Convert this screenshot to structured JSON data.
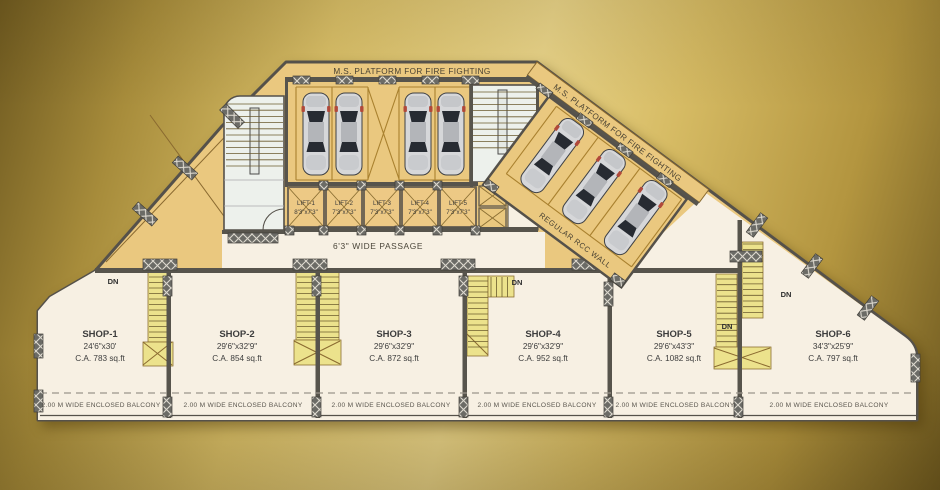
{
  "colors": {
    "gold-dark": "#6f5a20",
    "gold-mid": "#d9bf68",
    "gold-bright": "#e9d489",
    "plan-tan": "#eac87f",
    "plan-cream": "#f7f0e3",
    "stair-yellow": "#ece28c",
    "stair-floor": "#edf1ec",
    "wall-gray": "#57544c"
  },
  "plan": {
    "fire_platform_top": "M.S. PLATFORM FOR FIRE FIGHTING",
    "fire_platform_angled": "M.S. PLATFORM FOR FIRE FIGHTING",
    "rcc_wall": "REGULAR RCC WALL",
    "passage": "6'3\" WIDE PASSAGE",
    "down_label": "DN",
    "balcony": "2.00 M WIDE ENCLOSED BALCONY",
    "lifts": [
      {
        "name": "LIFT-1",
        "size": "8'3\"x7'3\""
      },
      {
        "name": "LIFT-2",
        "size": "7'3\"x7'3\""
      },
      {
        "name": "LIFT-3",
        "size": "7'3\"x7'3\""
      },
      {
        "name": "LIFT-4",
        "size": "7'3\"x7'3\""
      },
      {
        "name": "LIFT-5",
        "size": "7'3\"x7'3\""
      }
    ],
    "shops": [
      {
        "name": "SHOP-1",
        "size": "24'6\"x30'",
        "area": "C.A. 783 sq.ft"
      },
      {
        "name": "SHOP-2",
        "size": "29'6\"x32'9\"",
        "area": "C.A. 854 sq.ft"
      },
      {
        "name": "SHOP-3",
        "size": "29'6\"x32'9\"",
        "area": "C.A. 872 sq.ft"
      },
      {
        "name": "SHOP-4",
        "size": "29'6\"x32'9\"",
        "area": "C.A. 952 sq.ft"
      },
      {
        "name": "SHOP-5",
        "size": "29'6\"x43'3\"",
        "area": "C.A. 1082 sq.ft"
      },
      {
        "name": "SHOP-6",
        "size": "34'3\"x25'9\"",
        "area": "C.A. 797 sq.ft"
      }
    ]
  }
}
